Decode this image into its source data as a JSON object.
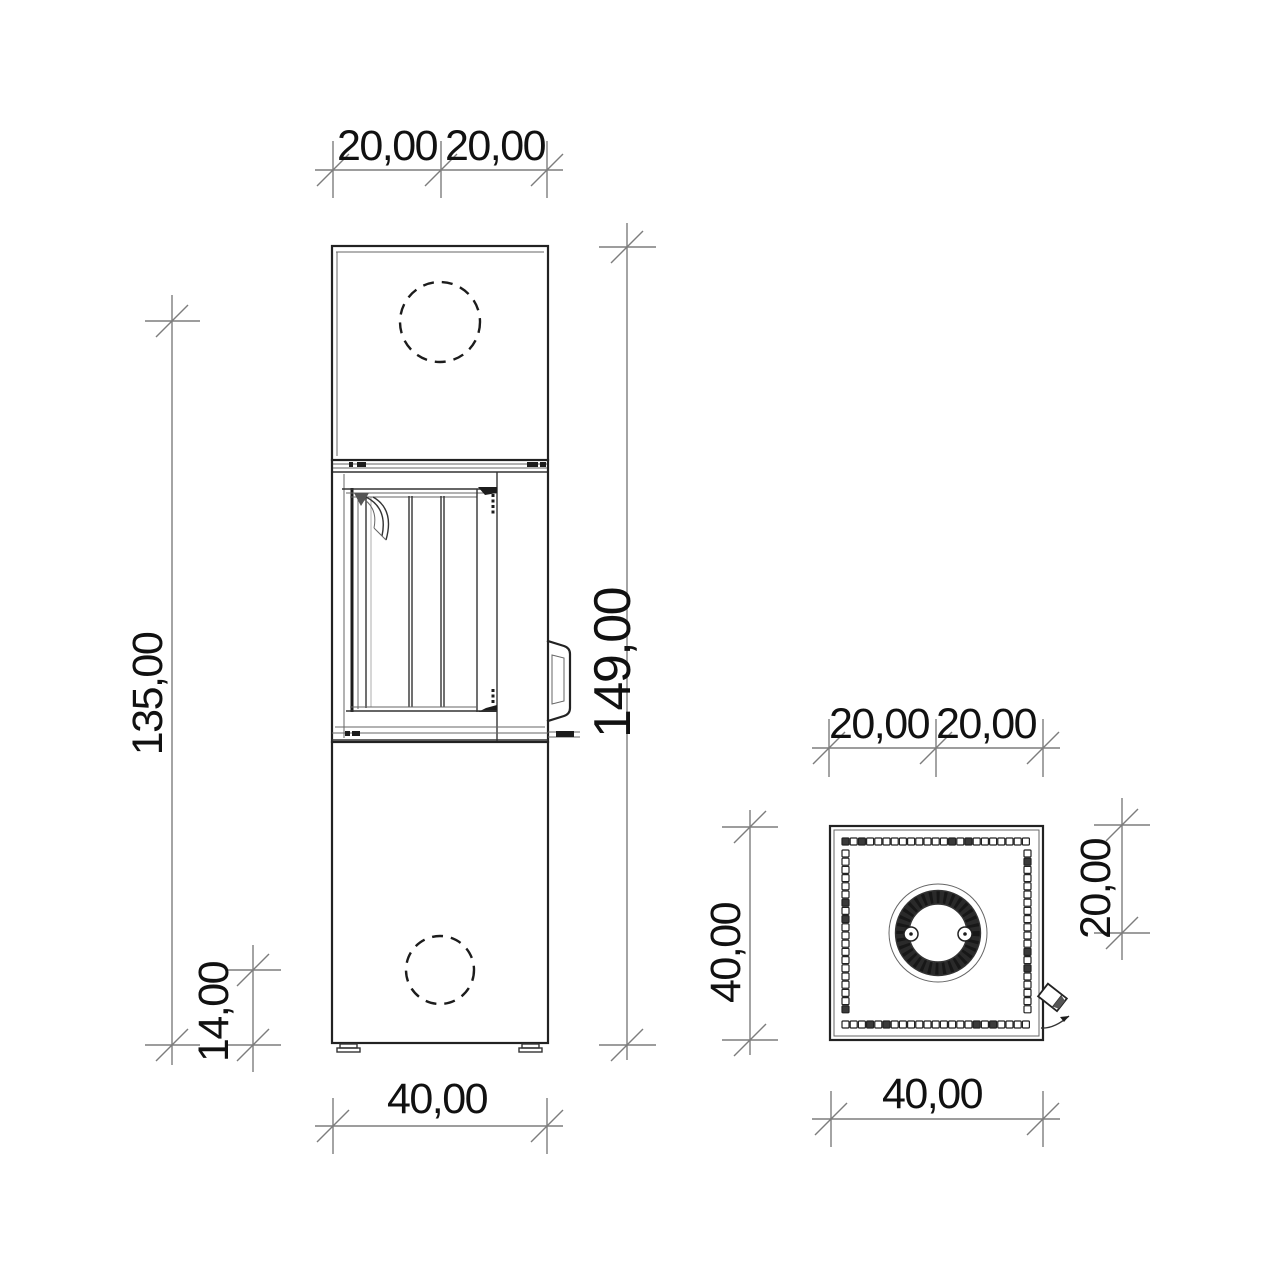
{
  "front_view": {
    "dim_top_left": "20,00",
    "dim_top_right": "20,00",
    "dim_flue_center_height": "135,00",
    "dim_total_height": "149,00",
    "dim_intake_center_height": "14,00",
    "dim_width": "40,00"
  },
  "plan_view": {
    "dim_top_left": "20,00",
    "dim_top_right": "20,00",
    "dim_depth": "40,00",
    "dim_flue_offset": "20,00",
    "dim_width": "40,00"
  },
  "colors": {
    "background": "#ffffff",
    "drawing_line": "#222222",
    "dimension_line": "#7d7d7d",
    "text": "#111111"
  }
}
